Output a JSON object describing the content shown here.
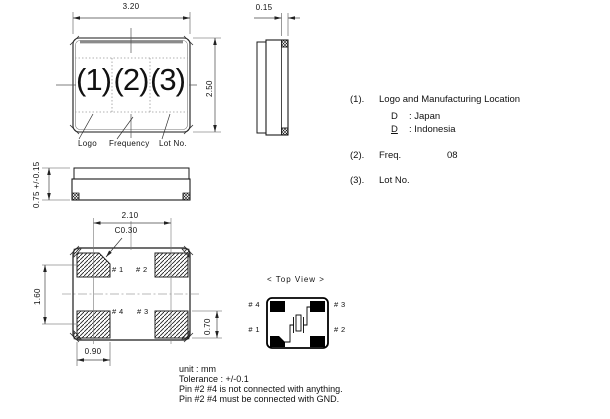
{
  "top_view": {
    "dim_width": "3.20",
    "dim_height": "2.50",
    "marking_1": "(1)",
    "marking_2": "(2)",
    "marking_3": "(3)",
    "label_logo": "Logo",
    "label_frequency": "Frequency",
    "label_lot_no": "Lot No."
  },
  "side_view": {
    "dim_lid": "0.15"
  },
  "front_view": {
    "dim_height": "0.75 +/-0.15"
  },
  "bottom_view": {
    "dim_pad_pitch_x": "2.10",
    "chamfer_callout": "C0.30",
    "dim_pad_pitch_y": "1.60",
    "dim_pad_width": "0.90",
    "dim_pad_height": "0.70",
    "pad_1": "# 1",
    "pad_2": "# 2",
    "pad_3": "# 3",
    "pad_4": "# 4"
  },
  "top_view_diagram": {
    "title": "< Top View >",
    "pin_1": "# 1",
    "pin_2": "# 2",
    "pin_3": "# 3",
    "pin_4": "# 4"
  },
  "legend": {
    "item1": {
      "num": "(1).",
      "text": "Logo and Manufacturing Location",
      "loc1_code": "D",
      "loc1_name": ": Japan",
      "loc2_code": "D",
      "loc2_name": ": Indonesia"
    },
    "item2": {
      "num": "(2).",
      "label": "Freq.",
      "value": "08"
    },
    "item3": {
      "num": "(3).",
      "label": "Lot No."
    }
  },
  "notes": {
    "unit": "unit : mm",
    "tolerance": "Tolerance : +/-0.1",
    "note1": "Pin #2 #4 is not connected with anything.",
    "note2": "Pin #2 #4 must be connected with GND."
  },
  "colors": {
    "line": "#1a1a1a",
    "dimension_line": "#444444",
    "background": "#ffffff"
  }
}
